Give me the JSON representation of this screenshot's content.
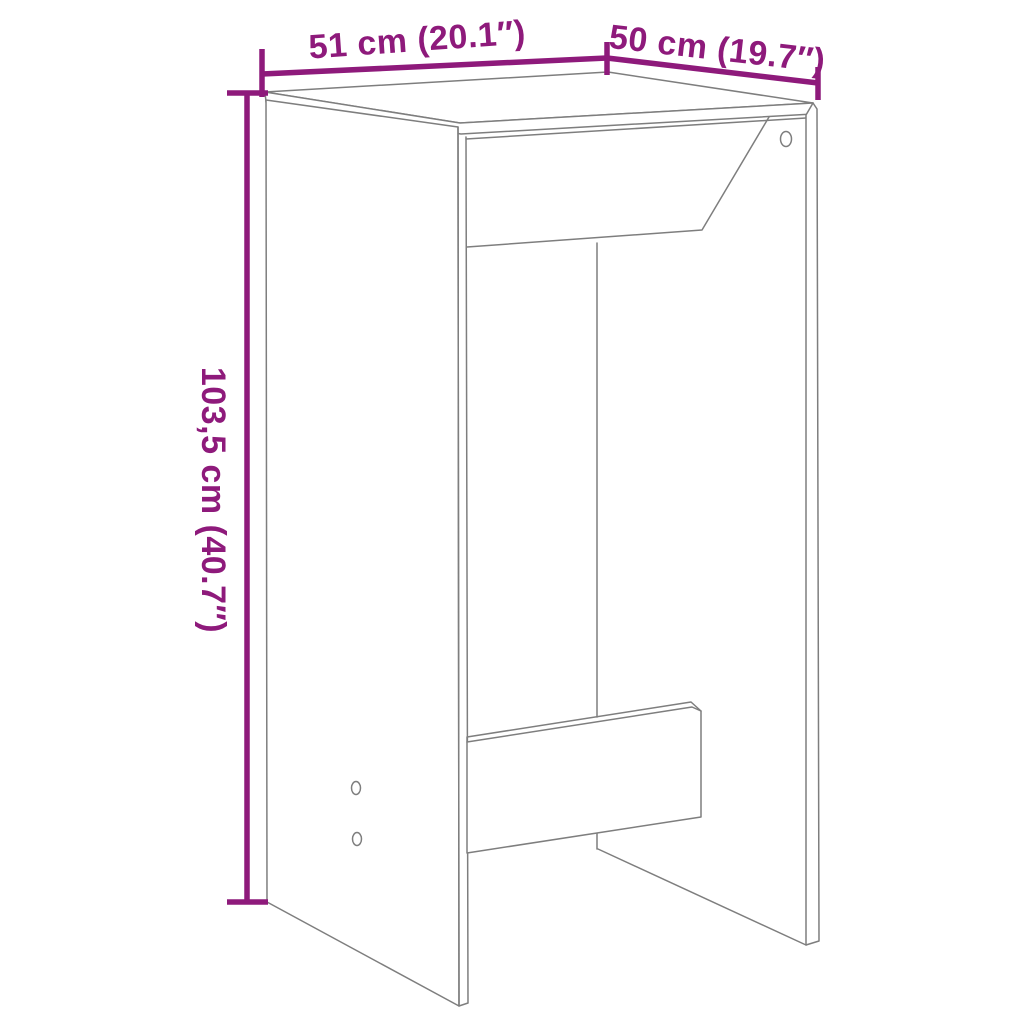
{
  "colors": {
    "accent": "#8E1A7B",
    "line": "#7E7E7E",
    "background": "#FFFFFF"
  },
  "dimension_labels": {
    "width": "51 cm (20.1″)",
    "depth": "50 cm (19.7″)",
    "height": "103,5 cm (40.7″)"
  }
}
